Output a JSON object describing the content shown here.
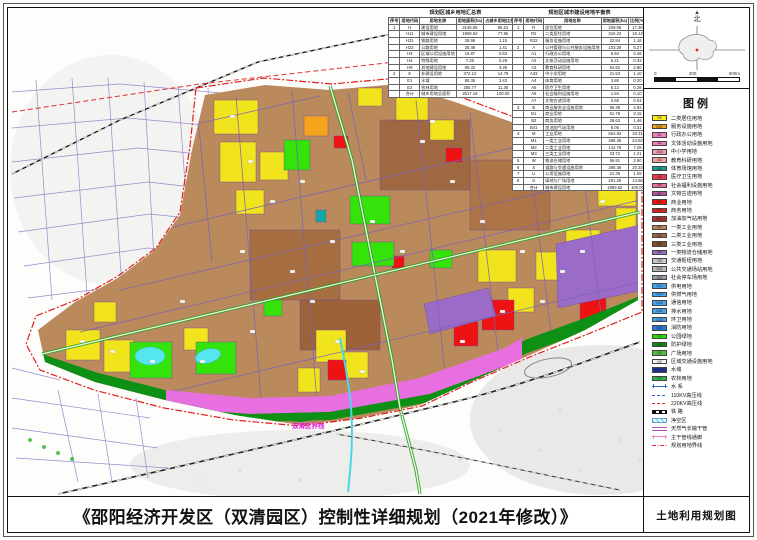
{
  "sheet": {
    "title": "《邵阳经济开发区（双清园区）控制性详细规划（2021年修改）》",
    "sheet_name": "土地利用规划图"
  },
  "compass": {
    "north_label": "北",
    "scale_labels": [
      "0",
      "300",
      "600m"
    ]
  },
  "map_labels": {
    "district_boundary": "双清区界线"
  },
  "tables": {
    "summary": {
      "title": "规划区城乡用地汇总表",
      "columns": [
        "序号",
        "用地代码",
        "用地名称",
        "用地面积(ha)",
        "占城乡用地比例(%)"
      ],
      "rows": [
        [
          "1",
          "H",
          "建设用地",
          "2145.06",
          "85.21"
        ],
        [
          "",
          "H11",
          "城市建设用地",
          "1959.62",
          "77.85"
        ],
        [
          "",
          "H21",
          "铁路用地",
          "28.96",
          "1.15"
        ],
        [
          "",
          "H22",
          "公路用地",
          "35.48",
          "1.41"
        ],
        [
          "",
          "H3",
          "区域公用设施用地",
          "15.87",
          "0.63"
        ],
        [
          "",
          "H4",
          "特殊用地",
          "7.26",
          "0.29"
        ],
        [
          "",
          "H9",
          "其他建设用地",
          "85.32",
          "3.39"
        ],
        [
          "2",
          "E",
          "非建设用地",
          "372.12",
          "14.79"
        ],
        [
          "",
          "E1",
          "水域",
          "86.35",
          "3.43"
        ],
        [
          "",
          "E2",
          "农林用地",
          "285.77",
          "11.36"
        ],
        [
          "",
          "合计",
          "城乡用地总面积",
          "2517.18",
          "100.00"
        ]
      ]
    },
    "balance": {
      "title": "规划区城市建设用地平衡表",
      "columns": [
        "序号",
        "用地代码",
        "用地名称",
        "用地面积(ha)",
        "比例(%)"
      ],
      "rows": [
        [
          "1",
          "R",
          "居住用地",
          "339.06",
          "17.30"
        ],
        [
          "",
          "R2",
          "二类居住用地",
          "316.22",
          "16.14"
        ],
        [
          "",
          "R22",
          "服务设施用地",
          "22.84",
          "1.16"
        ],
        [
          "2",
          "A",
          "公共管理与公共服务设施用地",
          "103.28",
          "5.27"
        ],
        [
          "",
          "A1",
          "行政办公用地",
          "8.94",
          "0.46"
        ],
        [
          "",
          "A2",
          "文体活动设施用地",
          "6.21",
          "0.32"
        ],
        [
          "",
          "A3",
          "教育科研用地",
          "54.82",
          "2.80"
        ],
        [
          "",
          "A33",
          "中小学用地",
          "21.53",
          "1.10"
        ],
        [
          "",
          "A4",
          "体育用地",
          "3.86",
          "0.20"
        ],
        [
          "",
          "A5",
          "医疗卫生用地",
          "5.12",
          "0.26"
        ],
        [
          "",
          "A6",
          "社会福利设施用地",
          "1.94",
          "0.10"
        ],
        [
          "",
          "A7",
          "文物古迹用地",
          "0.86",
          "0.04"
        ],
        [
          "3",
          "B",
          "商业服务业设施用地",
          "96.48",
          "4.92"
        ],
        [
          "",
          "B1",
          "商业用地",
          "61.79",
          "3.15"
        ],
        [
          "",
          "B2",
          "商务用地",
          "28.63",
          "1.46"
        ],
        [
          "",
          "B41",
          "加油加气站用地",
          "6.06",
          "0.31"
        ],
        [
          "4",
          "M",
          "工业用地",
          "652.83",
          "33.31"
        ],
        [
          "",
          "M1",
          "一类工业用地",
          "486.35",
          "24.82"
        ],
        [
          "",
          "M2",
          "二类工业用地",
          "142.76",
          "7.28"
        ],
        [
          "",
          "M3",
          "三类工业用地",
          "23.72",
          "1.21"
        ],
        [
          "5",
          "W",
          "物流仓储用地",
          "56.91",
          "2.90"
        ],
        [
          "6",
          "S",
          "道路与交通设施用地",
          "398.46",
          "20.33"
        ],
        [
          "7",
          "U",
          "公用设施用地",
          "21.35",
          "1.09"
        ],
        [
          "8",
          "G",
          "绿地与广场用地",
          "291.25",
          "14.86"
        ],
        [
          "",
          "合计",
          "城市建设用地",
          "1959.62",
          "100.00"
        ]
      ]
    }
  },
  "legend": {
    "title": "图例",
    "items": [
      {
        "code": "R2",
        "label": "二类居住用地",
        "color": "#F5EC1A",
        "symbol": "fill"
      },
      {
        "code": "R22",
        "label": "服务设施用地",
        "color": "#F5A31C",
        "symbol": "fill"
      },
      {
        "code": "A1",
        "label": "行政办公用地",
        "color": "#F080C0",
        "symbol": "fill"
      },
      {
        "code": "A2",
        "label": "文体活动设施用地",
        "color": "#F080C0",
        "symbol": "fill"
      },
      {
        "code": "A33",
        "label": "中小学用地",
        "color": "#F498B8",
        "symbol": "fill"
      },
      {
        "code": "A3",
        "label": "教育科研用地",
        "color": "#F5A0A0",
        "symbol": "fill"
      },
      {
        "code": "A4",
        "label": "体育场馆用地",
        "color": "#16A08C",
        "symbol": "fill"
      },
      {
        "code": "A5",
        "label": "医疗卫生用地",
        "color": "#EE3A4E",
        "symbol": "fill"
      },
      {
        "code": "A6",
        "label": "社会福利设施用地",
        "color": "#F06EA0",
        "symbol": "fill"
      },
      {
        "code": "A7",
        "label": "文物古迹用地",
        "color": "#B05898",
        "symbol": "fill"
      },
      {
        "code": "B1",
        "label": "商业用地",
        "color": "#F01010",
        "symbol": "fill"
      },
      {
        "code": "B2",
        "label": "商务用地",
        "color": "#E02020",
        "symbol": "fill"
      },
      {
        "code": "B41",
        "label": "加油加气站用地",
        "color": "#B03030",
        "symbol": "fill"
      },
      {
        "code": "M1",
        "label": "一类工业用地",
        "color": "#C08858",
        "symbol": "fill"
      },
      {
        "code": "M2",
        "label": "二类工业用地",
        "color": "#A06840",
        "symbol": "fill"
      },
      {
        "code": "M3",
        "label": "三类工业用地",
        "color": "#804E2A",
        "symbol": "fill"
      },
      {
        "code": "W1",
        "label": "一类物流仓储用地",
        "color": "#9B6BC8",
        "symbol": "fill"
      },
      {
        "code": "S3",
        "label": "交通枢纽用地",
        "color": "#C8C8C8",
        "symbol": "fill"
      },
      {
        "code": "S41",
        "label": "公共交通场站用地",
        "color": "#B8B8B8",
        "symbol": "fill"
      },
      {
        "code": "S42",
        "label": "社会停车场用地",
        "color": "#98A2AC",
        "symbol": "fill"
      },
      {
        "code": "U12",
        "label": "供电用地",
        "color": "#46A5F0",
        "symbol": "fill"
      },
      {
        "code": "U13",
        "label": "供燃气用地",
        "color": "#46A5F0",
        "symbol": "fill"
      },
      {
        "code": "U15",
        "label": "通信用地",
        "color": "#46A5F0",
        "symbol": "fill"
      },
      {
        "code": "U21",
        "label": "排水用地",
        "color": "#46A5F0",
        "symbol": "fill"
      },
      {
        "code": "U22",
        "label": "环卫用地",
        "color": "#46A5F0",
        "symbol": "fill"
      },
      {
        "code": "U31",
        "label": "消防用地",
        "color": "#2878D8",
        "symbol": "fill"
      },
      {
        "code": "G1",
        "label": "公园绿地",
        "color": "#28E000",
        "symbol": "fill"
      },
      {
        "code": "G2",
        "label": "防护绿地",
        "color": "#128A12",
        "symbol": "fill"
      },
      {
        "code": "G3",
        "label": "广场用地",
        "color": "#50C040",
        "symbol": "fill"
      },
      {
        "code": "H2",
        "label": "区域交通设施用地",
        "color": "#F4F4F4",
        "symbol": "fill"
      },
      {
        "code": "E1",
        "label": "水域",
        "color": "#203090",
        "symbol": "fill"
      },
      {
        "code": "E2",
        "label": "农林用地",
        "color": "#2EB44A",
        "symbol": "fill"
      },
      {
        "code": "",
        "label": "水  系",
        "color": "#3366CC",
        "symbol": "tick"
      },
      {
        "code": "",
        "label": "110KV高压线",
        "color": "#3355E0",
        "symbol": "dash"
      },
      {
        "code": "",
        "label": "220KV高压线",
        "color": "#E03030",
        "symbol": "dash"
      },
      {
        "code": "",
        "label": "铁  路",
        "color": "#111111",
        "symbol": "railway"
      },
      {
        "code": "",
        "label": "净空区",
        "color": "#66C2E8",
        "symbol": "hatch"
      },
      {
        "code": "",
        "label": "天然气长输干管",
        "color": "#B050B0",
        "symbol": "double"
      },
      {
        "code": "",
        "label": "主干管线通廊",
        "color": "#F080C0",
        "symbol": "tick"
      },
      {
        "code": "",
        "label": "规划用地界线",
        "color": "#E03030",
        "symbol": "dashdot"
      }
    ]
  }
}
